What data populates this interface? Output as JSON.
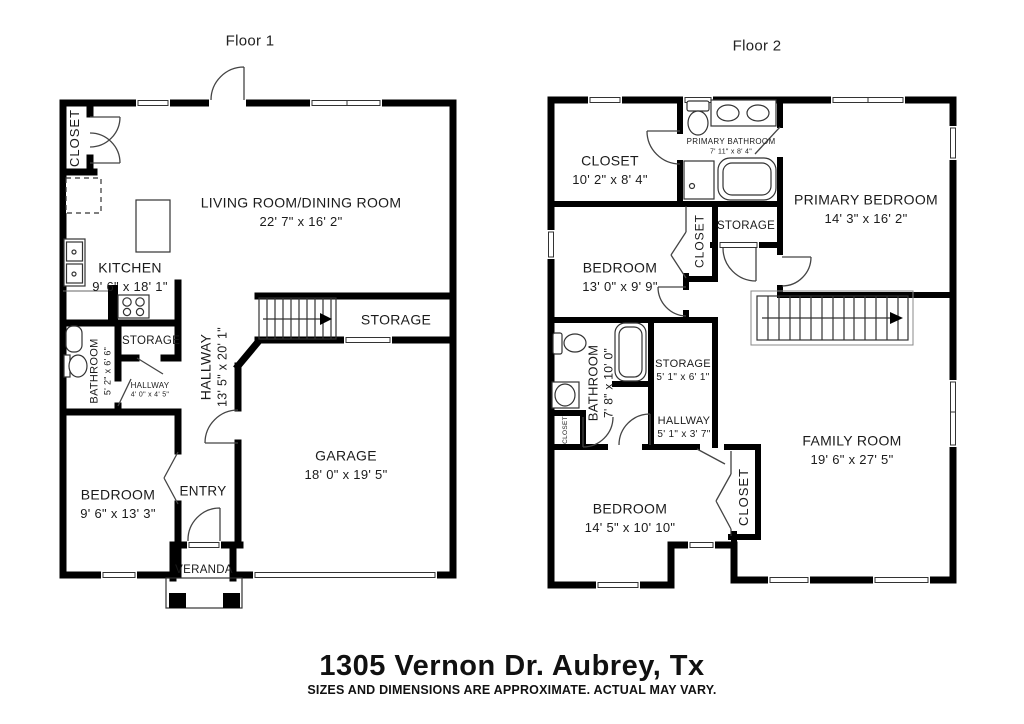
{
  "title": {
    "address": "1305 Vernon Dr. Aubrey, Tx",
    "disclaimer": "SIZES AND DIMENSIONS ARE APPROXIMATE. ACTUAL MAY VARY."
  },
  "floor1": {
    "label": "Floor 1",
    "rooms": {
      "closet": {
        "name": "CLOSET"
      },
      "living": {
        "name": "LIVING ROOM/DINING ROOM",
        "dims": "22' 7\" x 16' 2\""
      },
      "kitchen": {
        "name": "KITCHEN",
        "dims": "9' 6\" x 18' 1\""
      },
      "storage_hall": {
        "name": "STORAGE"
      },
      "bathroom": {
        "name": "BATHROOM",
        "dims": "5' 2\" x 6' 6\""
      },
      "hallway_small": {
        "name": "HALLWAY",
        "dims": "4' 0\" x 4' 5\""
      },
      "hallway": {
        "name": "HALLWAY",
        "dims": "13' 5\" x 20' 1\""
      },
      "storage_garage": {
        "name": "STORAGE"
      },
      "garage": {
        "name": "GARAGE",
        "dims": "18' 0\" x 19' 5\""
      },
      "bedroom": {
        "name": "BEDROOM",
        "dims": "9' 6\" x 13' 3\""
      },
      "entry": {
        "name": "ENTRY"
      },
      "veranda": {
        "name": "VERANDA"
      }
    }
  },
  "floor2": {
    "label": "Floor 2",
    "rooms": {
      "closet_top": {
        "name": "CLOSET",
        "dims": "10' 2\" x 8' 4\""
      },
      "primary_bath": {
        "name": "PRIMARY BATHROOM",
        "dims": "7' 11\" x 8' 4\""
      },
      "primary_bedroom": {
        "name": "PRIMARY BEDROOM",
        "dims": "14' 3\" x 16' 2\""
      },
      "storage_top": {
        "name": "STORAGE"
      },
      "closet_mid": {
        "name": "CLOSET"
      },
      "bedroom_mid": {
        "name": "BEDROOM",
        "dims": "13' 0\" x 9' 9\""
      },
      "bathroom": {
        "name": "BATHROOM",
        "dims": "7' 8\" x 10' 0\""
      },
      "storage_mid": {
        "name": "STORAGE",
        "dims": "5' 1\" x 6' 1\""
      },
      "hallway": {
        "name": "HALLWAY",
        "dims": "5' 1\" x 3' 7\""
      },
      "closet_tiny": {
        "name": "CLOSET"
      },
      "family": {
        "name": "FAMILY ROOM",
        "dims": "19' 6\" x 27' 5\""
      },
      "bedroom_bottom": {
        "name": "BEDROOM",
        "dims": "14' 5\" x 10' 10\""
      },
      "closet_bottom": {
        "name": "CLOSET"
      }
    }
  }
}
